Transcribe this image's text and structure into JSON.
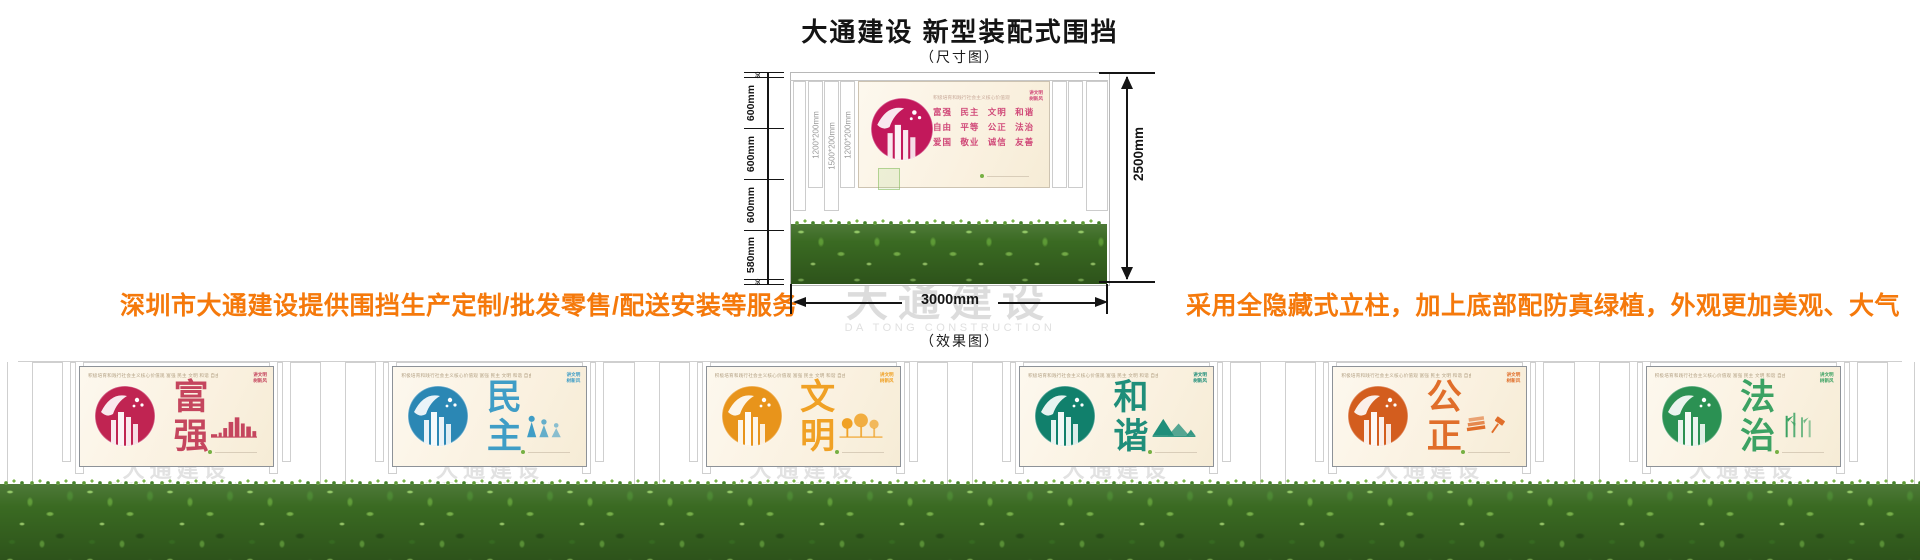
{
  "header": {
    "title": "大通建设 新型装配式围挡",
    "dim_caption": "（尺寸图）",
    "effect_caption": "（效果图）"
  },
  "notes": {
    "left": "深圳市大通建设提供围挡生产定制/批发零售/配送安装等服务",
    "right": "采用全隐藏式立柱，加上底部配防真绿植，外观更加美观、大气"
  },
  "colors": {
    "accent_orange": "#f5790b",
    "dimension_line": "#151515",
    "watermark_gray": "#dcdcdc",
    "panel_background": "#faf1e0",
    "hedge_green": "#3a6a22",
    "green_dot": "#76b043"
  },
  "diagram": {
    "left_dims": [
      "60",
      "600mm",
      "600mm",
      "600mm",
      "580mm",
      "60"
    ],
    "right_dim": "2500mm",
    "bottom_dim": "3000mm",
    "post_labels": [
      "1200*200mm",
      "1500*200mm",
      "1200*200mm"
    ],
    "sign": {
      "css": "--c:#d04878;--cc:#c2185b",
      "text_color": "#d04878",
      "tagline": "积极培育和践行社会主义核心价值观",
      "values_line1": "富强 民主 文明 和谐",
      "values_line2": "自由 平等 公正 法治",
      "values_line3": "爱国 敬业 诚信 友善",
      "badge_line1": "讲文明",
      "badge_line2": "树新风"
    },
    "watermark_cn": "大通建设",
    "watermark_en": "DA TONG CONSTRUCTION"
  },
  "panel_common": {
    "top_line": "积极培育和践行社会主义核心价值观  富强 民主 文明 和谐 自由 平等 公正 法治 爱国 敬业 诚信 友善",
    "badge_line1": "讲文明",
    "badge_line2": "树新风"
  },
  "panels": [
    {
      "word": "富强",
      "color": "#c5465e",
      "css": "--c:#c5465e;--cc:#c02452"
    },
    {
      "word": "民主",
      "color": "#3f9dc6",
      "css": "--c:#3f9dc6;--cc:#2b87b4"
    },
    {
      "word": "文明",
      "color": "#f0a125",
      "css": "--c:#f0a125;--cc:#e8941b"
    },
    {
      "word": "和谐",
      "color": "#1f8e7a",
      "css": "--c:#1f8e7a;--cc:#11806c"
    },
    {
      "word": "公正",
      "color": "#e06e2a",
      "css": "--c:#e06e2a;--cc:#d35d1e"
    },
    {
      "word": "法治",
      "color": "#3ca263",
      "css": "--c:#3ca263;--cc:#2b9153"
    }
  ]
}
